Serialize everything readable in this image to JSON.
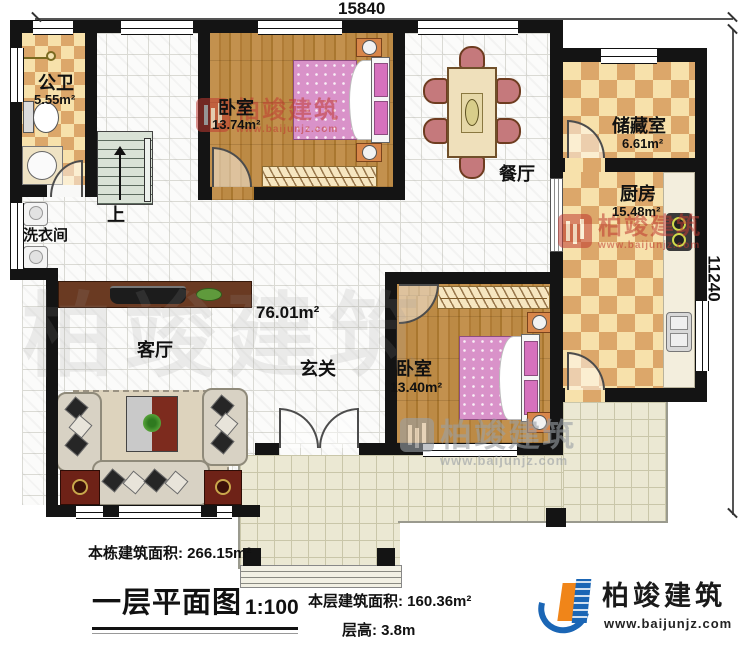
{
  "dimensions": {
    "width_label": "15840",
    "height_label": "11240"
  },
  "rooms": {
    "bathroom": {
      "name": "公卫",
      "area": "5.55m²"
    },
    "bedroom1": {
      "name": "卧室",
      "area": "13.74m²"
    },
    "dining": {
      "name": "餐厅"
    },
    "storage": {
      "name": "储藏室",
      "area": "6.61m²"
    },
    "kitchen": {
      "name": "厨房",
      "area": "15.48m²"
    },
    "laundry": {
      "name": "洗衣间"
    },
    "living": {
      "name": "客厅"
    },
    "hall": {
      "name": "玄关"
    },
    "bedroom2": {
      "name": "卧室",
      "area": "13.40m²"
    },
    "open_area": "76.01m²",
    "stairs_up": "上"
  },
  "annotations": {
    "building_area_label": "本栋建筑面积: 266.15m²",
    "title": "一层平面图",
    "scale": "1:100",
    "floor_area_label": "本层建筑面积: 160.36m²",
    "floor_height_label": "层高: 3.8m"
  },
  "branding": {
    "name": "柏竣建筑",
    "website": "www.baijunjz.com"
  },
  "colors": {
    "wall": "#141414",
    "checker_dark": "#dca76a",
    "checker_light": "#f7e1ab",
    "wood": "#b8853f",
    "terrace": "#ebe8d3",
    "bed_pink": "#d992c9",
    "logo_blue": "#1b66b5",
    "logo_orange": "#f08519",
    "watermark_red": "#c03a31"
  }
}
